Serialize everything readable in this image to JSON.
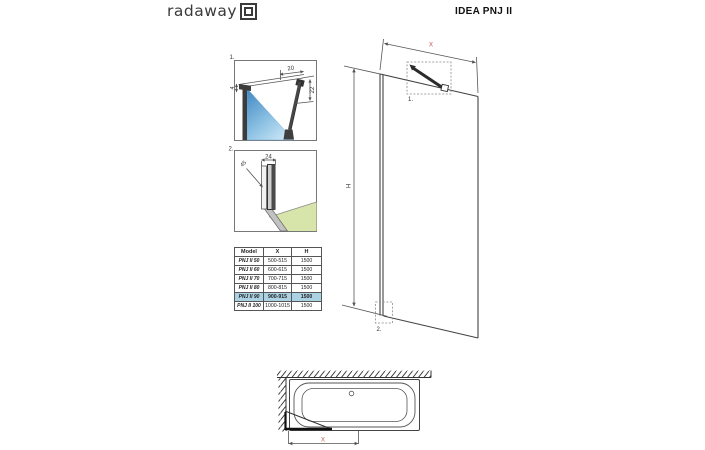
{
  "header": {
    "logo_text": "radaway",
    "title": "IDEA PNJ II"
  },
  "colors": {
    "accent_red": "#c9504c",
    "highlight_row_blue": "#abd2e2",
    "glass_gradient_dark": "#3e86c2",
    "glass_gradient_light": "#d9effa",
    "floor_green": "#d8e5aa",
    "line_dark": "#444444"
  },
  "detail1": {
    "label": "1.",
    "dim_top_width": "20",
    "dim_right_height": "22",
    "dim_left_gap": "4"
  },
  "detail2": {
    "label": "2.",
    "dim_profile_width": "24",
    "dim_angled": "45"
  },
  "main_drawing": {
    "dim_width_label": "X",
    "dim_height_label": "H",
    "callout1_label": "1.",
    "callout2_label": "2."
  },
  "tub_drawing": {
    "dim_width_label": "X"
  },
  "table": {
    "headers": [
      "Model",
      "X",
      "H"
    ],
    "rows": [
      {
        "model": "PNJ II 50",
        "x": "500-515",
        "h": "1500",
        "highlighted": false
      },
      {
        "model": "PNJ II 60",
        "x": "600-615",
        "h": "1500",
        "highlighted": false
      },
      {
        "model": "PNJ II 70",
        "x": "700-715",
        "h": "1500",
        "highlighted": false
      },
      {
        "model": "PNJ II 80",
        "x": "800-815",
        "h": "1500",
        "highlighted": false
      },
      {
        "model": "PNJ II 90",
        "x": "900-915",
        "h": "1500",
        "highlighted": true
      },
      {
        "model": "PNJ II 100",
        "x": "1000-1015",
        "h": "1500",
        "highlighted": false
      }
    ],
    "highlighted_model": "PNJ II 90"
  }
}
